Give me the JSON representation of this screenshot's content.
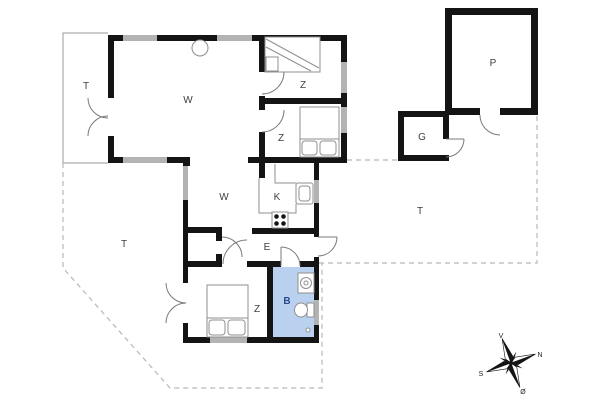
{
  "rooms": {
    "living": {
      "label": "W"
    },
    "dining": {
      "label": "W"
    },
    "kitchen": {
      "label": "K"
    },
    "entrance": {
      "label": "E"
    },
    "bedroom1": {
      "label": "Z"
    },
    "bedroom2": {
      "label": "Z"
    },
    "bedroom3": {
      "label": "Z"
    },
    "bath": {
      "label": "B"
    },
    "terrace1": {
      "label": "T"
    },
    "terrace2": {
      "label": "T"
    },
    "terrace3": {
      "label": "T"
    },
    "parking": {
      "label": "P"
    },
    "garage": {
      "label": "G"
    }
  },
  "compass": {
    "north": "N",
    "south": "S",
    "east": "Ø",
    "west": "V"
  },
  "colors": {
    "background": "#ffffff",
    "wall": "#141414",
    "window": "#b3b3b3",
    "bath_fill": "#b9d1ee",
    "bath_label": "#274b8e",
    "room_label": "#3f3f3f",
    "thin_line": "#8f8f8f",
    "dashed_line": "#b8b8b8"
  }
}
